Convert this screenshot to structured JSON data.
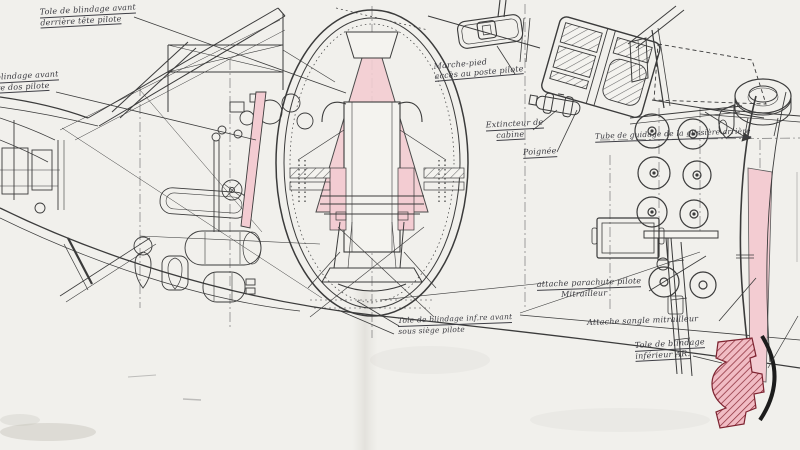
{
  "document": {
    "type": "aircraft-fuselage-armor-technical-drawing",
    "language": "French"
  },
  "colors": {
    "paper": "#f1f0ec",
    "ink": "#3b3b3b",
    "armor_pink": "#f3ccd2",
    "armor_hatch_red": "#8c2f3a",
    "arc_black": "#1c1c1c"
  },
  "labels": [
    {
      "id": "armor-behind-head",
      "line1": "Tole de blindage avant",
      "line2": "derrière tête pilote"
    },
    {
      "id": "armor-behind-back",
      "line1": "blindage avant",
      "line2": "re dos pilote"
    },
    {
      "id": "step-access",
      "line1": "Marche-pied",
      "line2": "accès au poste pilote"
    },
    {
      "id": "cabin-extinguisher",
      "line1": "Extincteur de",
      "line2": "cabine"
    },
    {
      "id": "handle",
      "line1": "Poignée"
    },
    {
      "id": "rear-slide-guide-tube",
      "line1": "Tube de guidage de la glissière arrière"
    },
    {
      "id": "parachute-attachment",
      "line1": "attache parachute pilote",
      "line2": "Mitrailleur"
    },
    {
      "id": "gunner-strap-attachment",
      "line1": "Attache sangle mitrailleur"
    },
    {
      "id": "lower-front-armor",
      "line1": "Tole de blindage inf.re avant",
      "line2": "sous siège pilote"
    },
    {
      "id": "lower-rear-armor",
      "line1": "Tole de blindage",
      "line2": "inférieur AR."
    }
  ]
}
